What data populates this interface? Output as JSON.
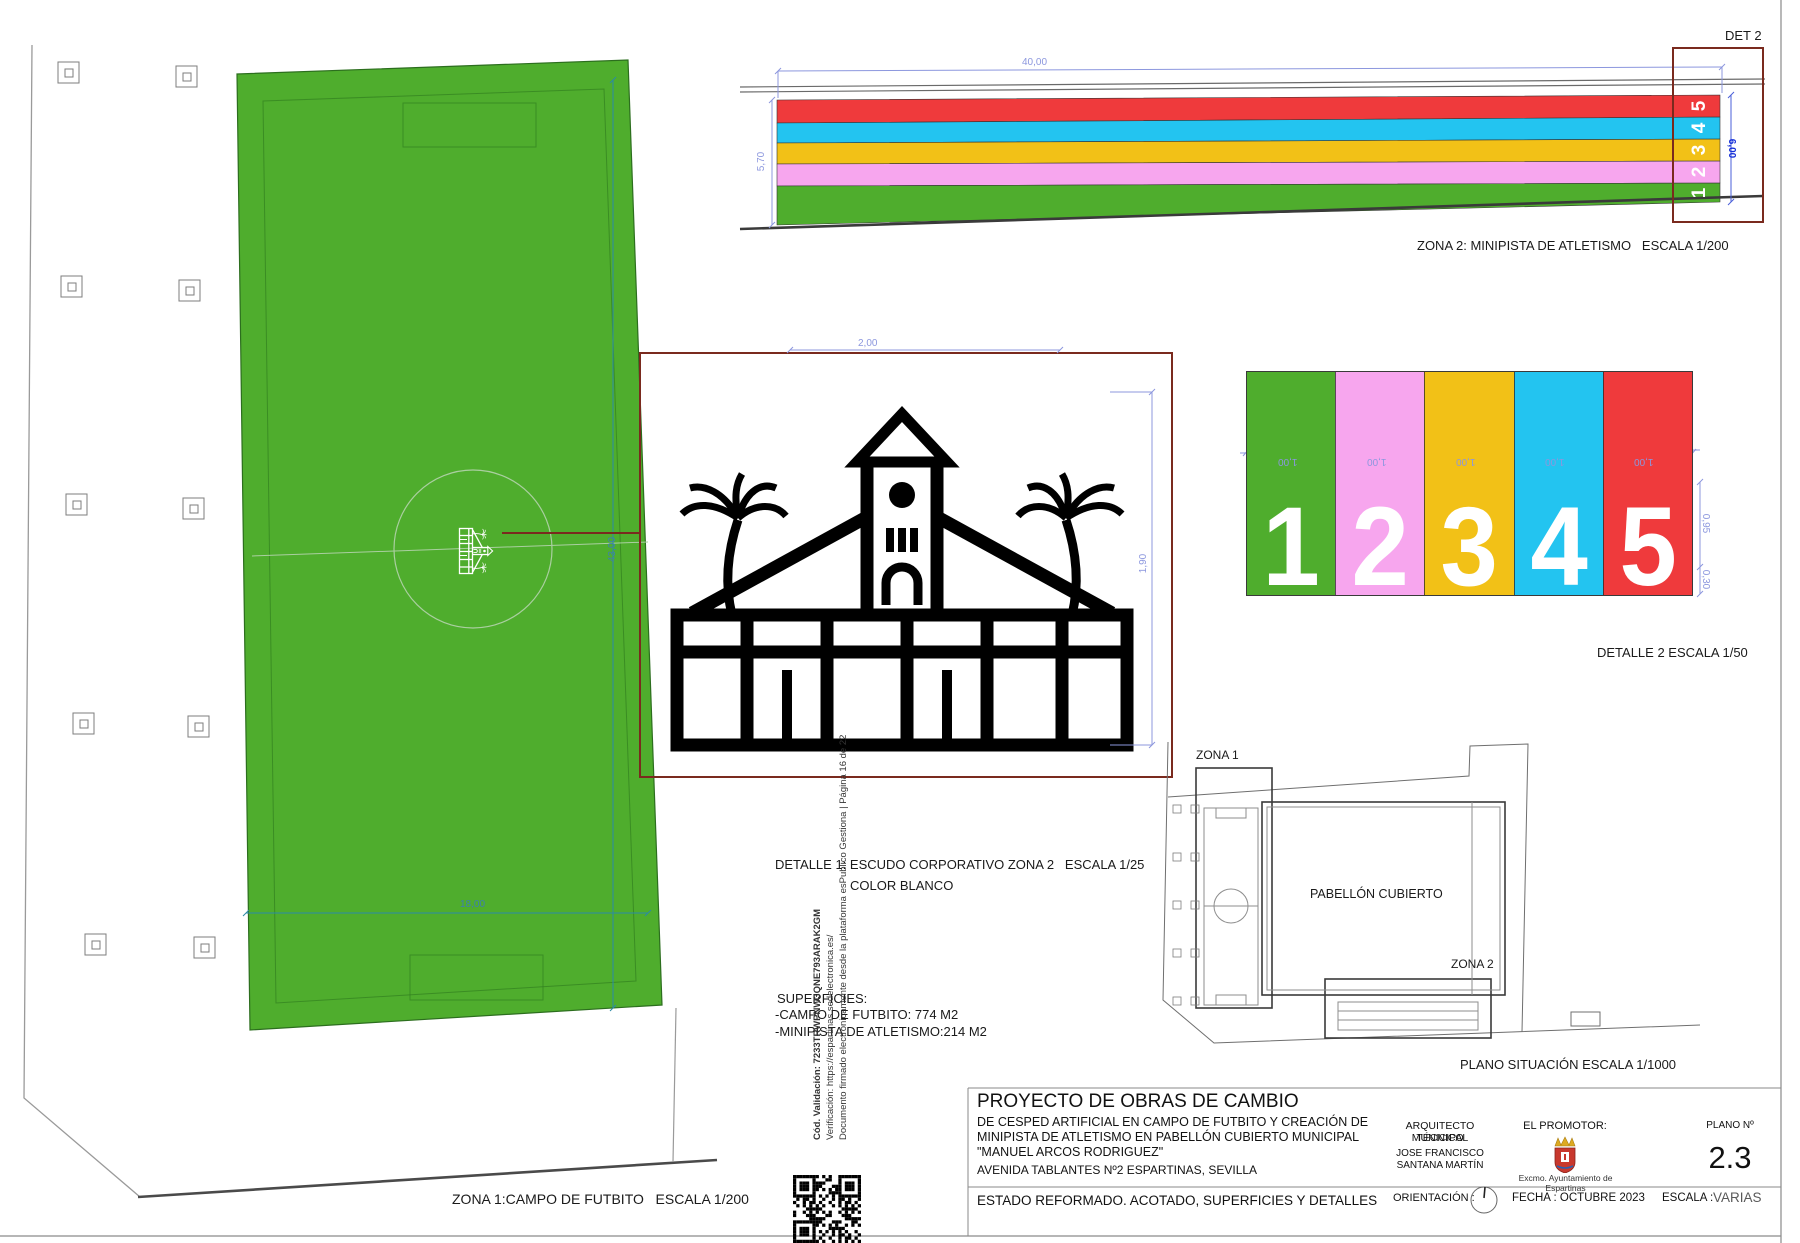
{
  "palette": {
    "dim_blue": "#8c97de",
    "dim_blue_dark": "#1630d8",
    "dim_teal": "#3f7fae",
    "detail_red": "#7a2a1e",
    "line_gray": "#8a8a8a",
    "line_dark": "#3a3a3a"
  },
  "zona1": {
    "caption": "ZONA 1:CAMPO DE FUTBITO   ESCALA 1/200",
    "turf_color": "#4FAD2D",
    "dim_w": "18,00",
    "dim_h": "43,00"
  },
  "zona2": {
    "caption": "ZONA 2: MINIPISTA DE ATLETISMO   ESCALA 1/200",
    "det_tag": "DET 2",
    "dim_top": "40,00",
    "dim_left": "5,70",
    "dim_right": "6,00",
    "lanes": [
      {
        "n": "1",
        "color": "#4FAD2D"
      },
      {
        "n": "2",
        "color": "#F7A6EE"
      },
      {
        "n": "3",
        "color": "#F2C117"
      },
      {
        "n": "4",
        "color": "#23C4F0"
      },
      {
        "n": "5",
        "color": "#EF3A3C"
      }
    ]
  },
  "detalle1": {
    "caption_1": "DETALLE 1: ESCUDO CORPORATIVO ZONA 2   ESCALA 1/25",
    "caption_2": "COLOR BLANCO",
    "dim_w": "2,00",
    "dim_h": "1,90"
  },
  "detalle2": {
    "caption": "DETALLE 2 ESCALA 1/50",
    "lane_w": "1,00",
    "dim_a": "0,95",
    "dim_b": "0,30"
  },
  "situacion": {
    "caption": "PLANO SITUACIÓN ESCALA 1/1000",
    "zona1_tag": "ZONA 1",
    "zona2_tag": "ZONA 2",
    "pabellon": "PABELLÓN CUBIERTO"
  },
  "superficies": {
    "title": "SUPERFICIES:",
    "item1": "-CAMPO DE FUTBITO: 774 M2",
    "item2": "-MINIPISTA DE ATLETISMO:214 M2"
  },
  "title_block": {
    "project_title": "PROYECTO DE OBRAS DE CAMBIO",
    "project_line1": "DE CESPED ARTIFICIAL EN CAMPO DE FUTBITO Y CREACIÓN DE",
    "project_line2": "MINIPISTA DE ATLETISMO EN PABELLÓN CUBIERTO MUNICIPAL",
    "project_line3": "\"MANUEL ARCOS RODRIGUEZ\"",
    "address": "AVENIDA TABLANTES Nº2 ESPARTINAS, SEVILLA",
    "sheet_name": "ESTADO REFORMADO. ACOTADO, SUPERFICIES Y DETALLES",
    "architect_role1": "ARQUITECTO TÉCNICO",
    "architect_role2": "MUNICIPAL",
    "architect_name1": "JOSE FRANCISCO",
    "architect_name2": "SANTANA MARTÍN",
    "promoter_label": "EL PROMOTOR:",
    "promoter_name": "Excmo. Ayuntamiento de Espartinas",
    "plano_label": "PLANO Nº",
    "plano_number": "2.3",
    "orientation_label": "ORIENTACIÓN :",
    "fecha_label": "FECHA : OCTUBRE 2023",
    "escala_label": "ESCALA :",
    "escala_value": "VARIAS"
  },
  "signature": {
    "line1": "Cód. Validación: 7233TRWPNW3QNE793ARAK2GM",
    "line2": "Verificación: https://espartinas.sedelectronica.es/",
    "line3": "Documento firmado electrónicamente desde la plataforma esPublico Gestiona | Página 16 de 22"
  }
}
